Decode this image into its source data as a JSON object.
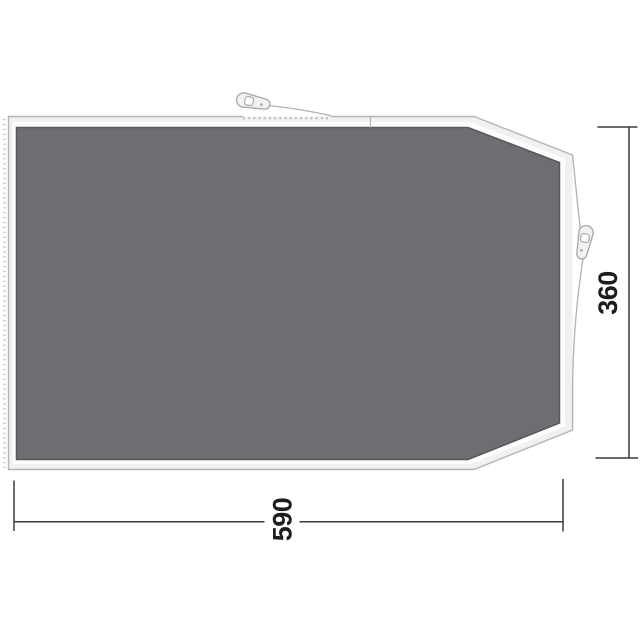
{
  "diagram": {
    "type": "tent-footprint-groundsheet-top-view",
    "dimensions": {
      "width_label": "590",
      "height_label": "360"
    },
    "icons": [
      "zipper-pull-top-icon",
      "zipper-pull-right-icon"
    ],
    "colors": {
      "background": "#ffffff",
      "sheet_fill": "#f1f1f2",
      "sheet_stroke": "#b3b5b7",
      "halo": "#fdfdfd",
      "panel_fill": "#6d6e72",
      "panel_stroke": "#56585b",
      "stitch": "#cbccce",
      "teeth": "#b7b9bb",
      "cord": "#b0b2b4",
      "zipper_fill": "#f2f2f3",
      "zipper_stroke": "#a8aaac",
      "dimension": "#3b3b3d",
      "label_text": "#1e1e20"
    }
  }
}
